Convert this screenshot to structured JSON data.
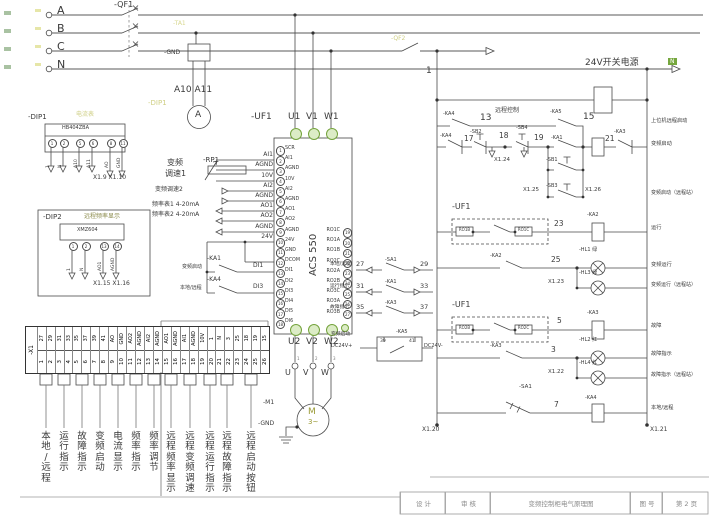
{
  "power": {
    "phases": [
      "A",
      "B",
      "C",
      "N"
    ],
    "breaker": "-QF1",
    "aux_breaker": "-QF2",
    "control_wire": "1",
    "neutral_tag": "N"
  },
  "metering": {
    "ct_ref": "-TA1",
    "transformer_gnd": "-GND",
    "ammeter_wires": "A10 A11",
    "ammeter_symbol": "A",
    "dip1_ref_hl": "-DIP1",
    "dip1_function": "电流表"
  },
  "dip1": {
    "ref": "-DIP1",
    "model": "HB404ZBA",
    "pins": [
      "1",
      "2",
      "5",
      "6",
      "8",
      "11"
    ],
    "signals": [
      "1",
      "N",
      "A10",
      "A11",
      "AO",
      "GND"
    ],
    "xref": "X1.9 X1.10"
  },
  "dip2": {
    "ref": "-DIP2",
    "function": "远程频率显示",
    "model": "XMZ604",
    "pins": [
      "1",
      "2",
      "13",
      "14"
    ],
    "signals": [
      "1",
      "N",
      "AO1",
      "AGND"
    ],
    "xref": "X1.15 X1.16"
  },
  "drive": {
    "ref": "-UF1",
    "model": "ACS 550",
    "top_terminals": [
      "U1",
      "V1",
      "W1"
    ],
    "bottom_terminals": [
      "U2",
      "V2",
      "W2"
    ],
    "left_terminals": [
      {
        "n": "1",
        "s": "SCR"
      },
      {
        "n": "2",
        "s": "AI1"
      },
      {
        "n": "3",
        "s": "AGND"
      },
      {
        "n": "4",
        "s": "10V"
      },
      {
        "n": "5",
        "s": "AI2"
      },
      {
        "n": "6",
        "s": "AGND"
      },
      {
        "n": "7",
        "s": "AO1"
      },
      {
        "n": "8",
        "s": "AO2"
      },
      {
        "n": "9",
        "s": "AGND"
      },
      {
        "n": "10",
        "s": "24V"
      },
      {
        "n": "11",
        "s": "GND"
      },
      {
        "n": "12",
        "s": "DCOM"
      },
      {
        "n": "13",
        "s": "DI1"
      },
      {
        "n": "14",
        "s": "DI2"
      },
      {
        "n": "15",
        "s": "DI3"
      },
      {
        "n": "16",
        "s": "DI4"
      },
      {
        "n": "17",
        "s": "DI5"
      },
      {
        "n": "18",
        "s": "DI6"
      }
    ],
    "right_terminals": [
      {
        "n": "19",
        "s": "RO1C"
      },
      {
        "n": "20",
        "s": "RO1A"
      },
      {
        "n": "21",
        "s": "RO1B"
      },
      {
        "n": "22",
        "s": "RO2C"
      },
      {
        "n": "23",
        "s": "RO2A"
      },
      {
        "n": "24",
        "s": "RO2B"
      },
      {
        "n": "25",
        "s": "RO3C"
      },
      {
        "n": "26",
        "s": "RO3A"
      },
      {
        "n": "27",
        "s": "RO3B"
      }
    ]
  },
  "analog": {
    "pot_ref": "-RP1",
    "fn_line1": "变频",
    "fn_line2": "调速1",
    "fn2": "变频调速2",
    "fn3": "频率表1 4-20mA",
    "fn4": "频率表2 4-20mA",
    "wire_labels": [
      "AI1",
      "AGND",
      "10V",
      "AI2",
      "AGND",
      "AO1",
      "AO2",
      "AGND",
      "24V"
    ]
  },
  "digital": {
    "ka1": "-KA1",
    "di1": "DI1",
    "fn_start": "变频启动",
    "ka4": "-KA4",
    "di3": "DI3",
    "fn_mode": "本地/远程"
  },
  "motor": {
    "ref": "-M1",
    "symbol": "M",
    "phase": "3~",
    "gnd": "-GND",
    "wires": [
      "U",
      "V",
      "W"
    ],
    "pins": [
      "1",
      "2",
      "3"
    ]
  },
  "feedback": {
    "rows": [
      {
        "fn": "本地/远程",
        "lw": "27",
        "dev": "-SA1",
        "rw": "29"
      },
      {
        "fn": "运行指示",
        "lw": "31",
        "dev": "-KA1",
        "rw": "33"
      },
      {
        "fn": "故障指示",
        "lw": "35",
        "dev": "-KA3",
        "rw": "37"
      }
    ],
    "ka5": {
      "fn": "变频启动",
      "plus": "DC24V+",
      "minus": "DC24V-",
      "ref": "-KA5",
      "pin_l": "39",
      "pin_r": "41"
    }
  },
  "ladder": {
    "psu": "24V开关电源",
    "r1": {
      "c1": "-KA4",
      "w1": "13",
      "fn": "远程控制",
      "c2": "-KA5",
      "w2": "15",
      "label": "上位机远程启动"
    },
    "r2": {
      "c1": "-KA4",
      "w1": "17",
      "c2": "-SB2",
      "w2": "18",
      "xref": "X1.24",
      "c3": "-SB4",
      "w3": "19",
      "c4": "-KA1",
      "w4": "21",
      "c5": "-KA3",
      "b1": "-SB1",
      "b2": "-SB3",
      "x25": "X1.25",
      "x26": "X1.26",
      "label": "变频启动",
      "label2": "变频启动（远程站）"
    },
    "r3": {
      "ref": "-UF1",
      "p1": "RO1B",
      "p2": "RO1C",
      "w": "23",
      "coil": "-KA2",
      "label": "运行"
    },
    "r4": {
      "c": "-KA2",
      "w": "25",
      "lamp": "-HL1 绿",
      "label": "变频运行",
      "xref": "X1.23",
      "lamp2": "-HL3 绿",
      "label2": "变频运行（远程站）"
    },
    "r5": {
      "ref": "-UF1",
      "p1": "RO2B",
      "p2": "RO2C",
      "w": "5",
      "coil": "-KA3",
      "label": "故障"
    },
    "r6": {
      "c": "-KA3",
      "w": "3",
      "lamp": "-HL2 红",
      "label": "故障指示",
      "xref": "X1.22",
      "lamp2": "-HL4 红",
      "label2": "故障指示（远程站）"
    },
    "r7": {
      "sw": "-SA1",
      "w": "7",
      "coil": "-KA4",
      "label": "本地/远程"
    },
    "x20": "X1.20",
    "x21": "X1.21"
  },
  "x1_strip": {
    "ref": "-X1",
    "wires": [
      "27",
      "29",
      "31",
      "33",
      "35",
      "37",
      "39",
      "41",
      "AO",
      "GND",
      "AO2",
      "AGND",
      "AI2",
      "AGND",
      "AO1",
      "AGND",
      "AI1",
      "AGND",
      "10V",
      "1",
      "N",
      "3",
      "25",
      "18",
      "19",
      "15"
    ],
    "terminals": [
      "1",
      "2",
      "3",
      "4",
      "5",
      "6",
      "7",
      "8",
      "9",
      "10",
      "11",
      "12",
      "13",
      "14",
      "15",
      "16",
      "17",
      "18",
      "19",
      "20",
      "21",
      "22",
      "23",
      "24",
      "25",
      "26"
    ]
  },
  "bottom_labels": [
    "本地/远程",
    "运行指示",
    "故障指示",
    "变频启动",
    "电流显示",
    "频率指示",
    "频率调节",
    "远程频率显示",
    "远程变频调速",
    "远程运行指示",
    "远程故障指示",
    "远程启动按钮"
  ],
  "title_block": {
    "c1": "设 计",
    "c2": "审 核",
    "c3": "变频控制柜电气原理图",
    "c4": "图 号",
    "c5": "第 2 页"
  }
}
